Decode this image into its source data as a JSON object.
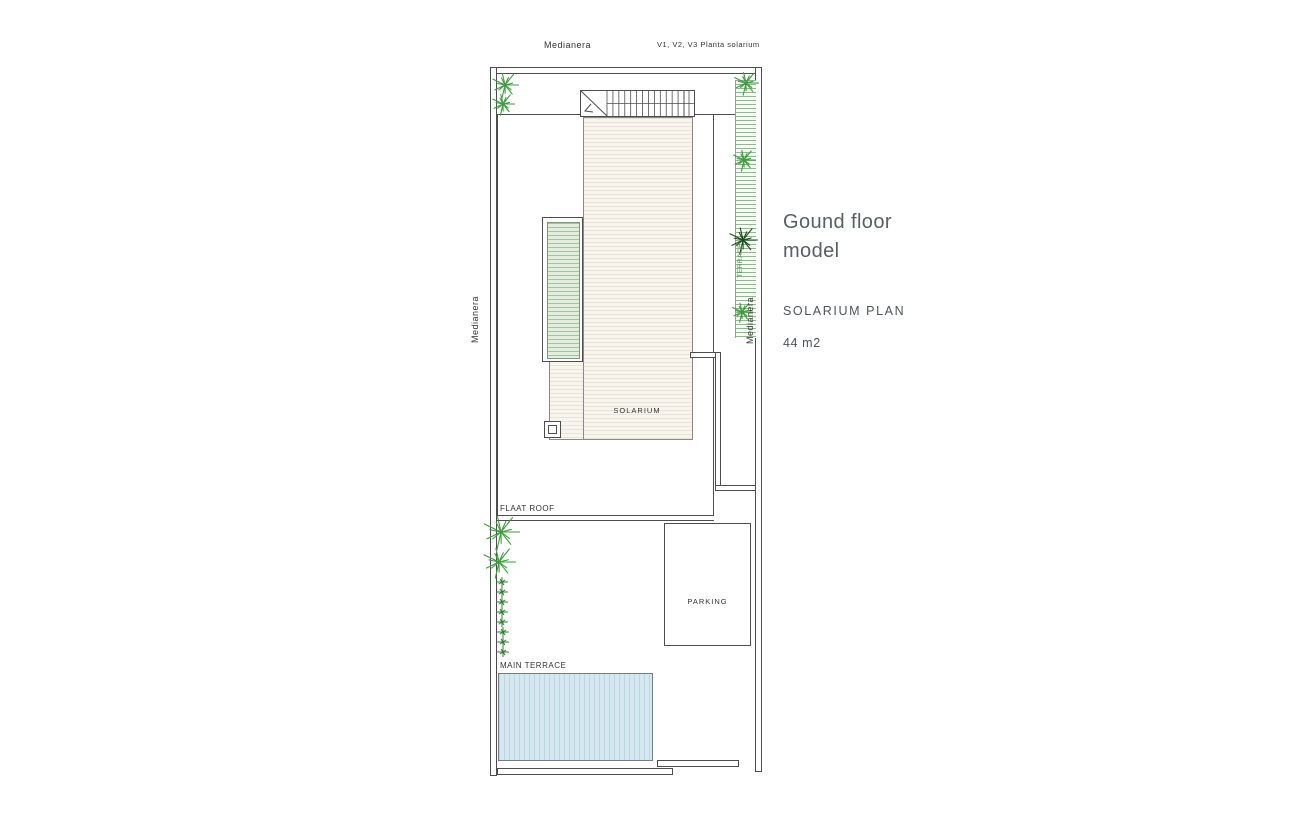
{
  "plan": {
    "labels": {
      "medianera_top": "Medianera",
      "window_note": "V1, V2, V3 Planta solarium",
      "medianera_left": "Medianera",
      "medianera_right": "Medianera",
      "flat_roof": "FLAAT ROOF",
      "solarium": "SOLARIUM",
      "parking": "PARKING",
      "main_terrace": "MAIN TERRACE",
      "terrace_strip": "TERRACE"
    },
    "stairs": {
      "tread_count": 13
    },
    "plants": [
      {
        "x": 505,
        "y": 85,
        "s": 28,
        "tone": "green"
      },
      {
        "x": 503,
        "y": 104,
        "s": 24,
        "tone": "green"
      },
      {
        "x": 746,
        "y": 83,
        "s": 26,
        "tone": "green"
      },
      {
        "x": 744,
        "y": 160,
        "s": 24,
        "tone": "green"
      },
      {
        "x": 743,
        "y": 240,
        "s": 30,
        "tone": "dark"
      },
      {
        "x": 742,
        "y": 312,
        "s": 22,
        "tone": "green"
      },
      {
        "x": 501,
        "y": 532,
        "s": 38,
        "tone": "green"
      },
      {
        "x": 499,
        "y": 562,
        "s": 34,
        "tone": "green"
      },
      {
        "x": 502,
        "y": 582,
        "s": 12,
        "tone": "mid"
      },
      {
        "x": 502,
        "y": 592,
        "s": 12,
        "tone": "mid"
      },
      {
        "x": 502,
        "y": 602,
        "s": 12,
        "tone": "mid"
      },
      {
        "x": 502,
        "y": 612,
        "s": 12,
        "tone": "mid"
      },
      {
        "x": 502,
        "y": 622,
        "s": 12,
        "tone": "mid"
      },
      {
        "x": 503,
        "y": 632,
        "s": 12,
        "tone": "mid"
      },
      {
        "x": 503,
        "y": 642,
        "s": 12,
        "tone": "mid"
      },
      {
        "x": 503,
        "y": 652,
        "s": 12,
        "tone": "mid"
      }
    ],
    "colors": {
      "line": "#4d4d4d",
      "plant_green": "#3f9b3f",
      "plant_mid": "#2e7d2e",
      "plant_dark": "#1f4a1f",
      "pool_fill": "#d6e8ef",
      "pool_stripe": "#b9d7e2",
      "planter_fill": "#e3ecdd",
      "planter_line": "#a3c29e",
      "strip_line": "#8abc8a",
      "solarium_fill": "#f8f5ef",
      "solarium_line": "#eae3d6"
    }
  },
  "panel": {
    "heading": "Gound floor model",
    "plan_title": "SOLARIUM PLAN",
    "area": "44 m2"
  }
}
